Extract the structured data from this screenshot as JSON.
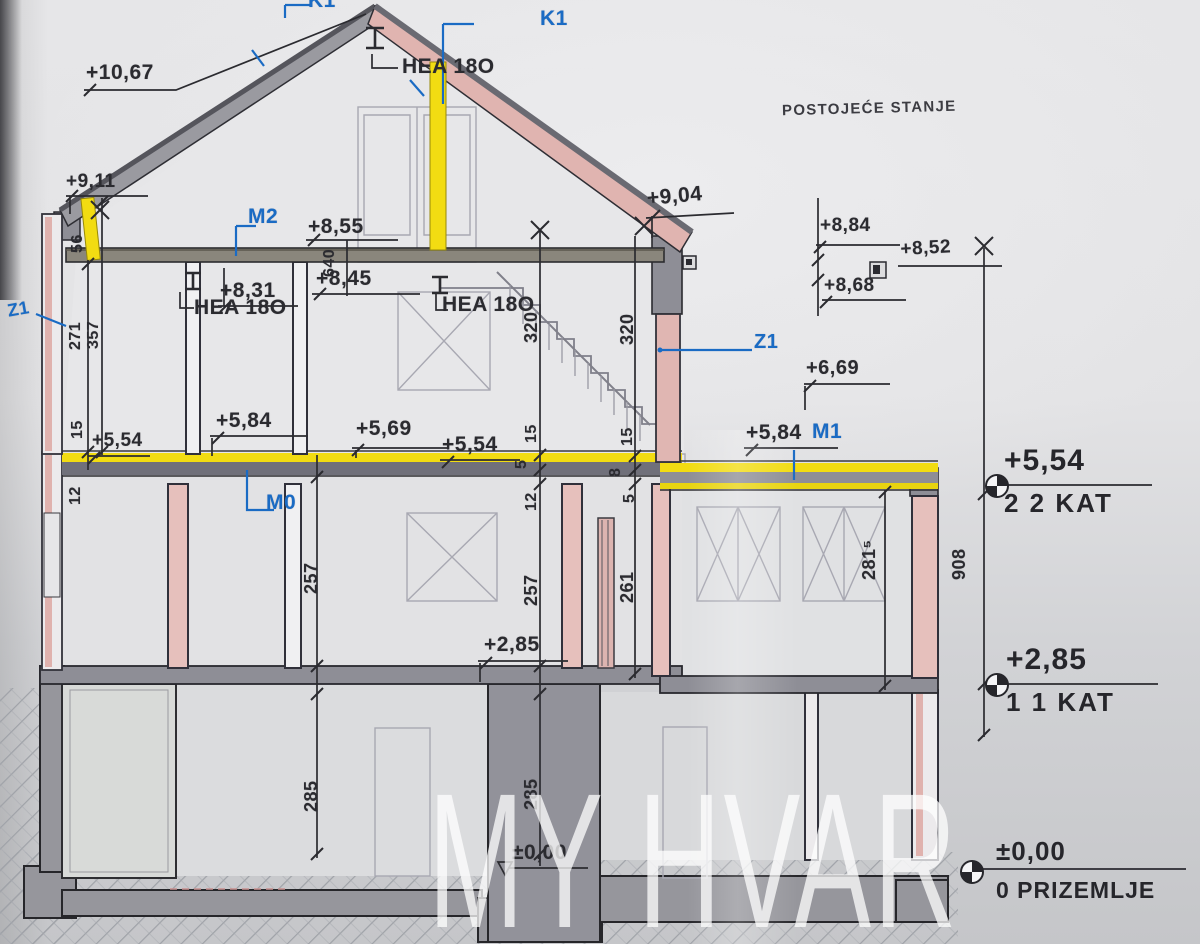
{
  "title": "POSTOJEĆE STANJE",
  "watermark": "MY HVAR",
  "drawing_type": "building cross-section, existing state",
  "colors": {
    "ink": "#2b2b30",
    "blue": "#1a6bc4",
    "highlight_yellow": "#f2dc12",
    "roof_pink": "#e0b4b0",
    "wall_pink": "#e6c0bc",
    "slab_gray": "#8e8e96",
    "ghost_gray": "#a8a8b2",
    "paper": "#e4e4e6"
  },
  "levels": [
    {
      "value": "+5,54",
      "name": "2 2 KAT"
    },
    {
      "value": "+2,85",
      "name": "1 1 KAT"
    },
    {
      "value": "±0,00",
      "name": "0 PRIZEMLJE"
    }
  ],
  "annotations": [
    {
      "id": "dim-plus-10-67",
      "text": "+10,67",
      "x": 86,
      "y": 62,
      "size": 21
    },
    {
      "id": "dim-plus-9-11",
      "text": "+9,11",
      "x": 66,
      "y": 172,
      "size": 19
    },
    {
      "id": "dim-56",
      "text": "56",
      "x": 70,
      "y": 253,
      "rot": -90,
      "size": 16
    },
    {
      "id": "label-k1-top",
      "text": "K1",
      "x": 308,
      "y": -10,
      "size": 21,
      "color": "blue",
      "bold": true
    },
    {
      "id": "label-k1-right",
      "text": "K1",
      "x": 540,
      "y": 8,
      "size": 21,
      "color": "blue",
      "bold": true
    },
    {
      "id": "label-hea-180-top",
      "text": "HEA 18O",
      "x": 402,
      "y": 56,
      "size": 21
    },
    {
      "id": "label-m2",
      "text": "M2",
      "x": 248,
      "y": 206,
      "size": 21,
      "color": "blue",
      "bold": true
    },
    {
      "id": "dim-plus-8-55",
      "text": "+8,55",
      "x": 308,
      "y": 216,
      "size": 21
    },
    {
      "id": "dim-640",
      "text": "640",
      "x": 322,
      "y": 277,
      "rot": -90,
      "size": 16
    },
    {
      "id": "dim-plus-8-45",
      "text": "+8,45",
      "x": 316,
      "y": 268,
      "size": 21
    },
    {
      "id": "dim-plus-8-31",
      "text": "+8,31",
      "x": 220,
      "y": 280,
      "size": 21
    },
    {
      "id": "label-hea-180-left",
      "text": "HEA 18O",
      "x": 194,
      "y": 297,
      "size": 21
    },
    {
      "id": "label-hea-180-mid",
      "text": "HEA 18O",
      "x": 442,
      "y": 294,
      "size": 21
    },
    {
      "id": "dim-plus-9-04",
      "text": "+9,04",
      "x": 646,
      "y": 188,
      "size": 21,
      "rot": -5
    },
    {
      "id": "dim-plus-8-84",
      "text": "+8,84",
      "x": 820,
      "y": 216,
      "size": 19
    },
    {
      "id": "dim-plus-8-52",
      "text": "+8,52",
      "x": 900,
      "y": 240,
      "size": 19,
      "rot": -3
    },
    {
      "id": "dim-plus-8-68",
      "text": "+8,68",
      "x": 824,
      "y": 276,
      "size": 19
    },
    {
      "id": "label-z1-left",
      "text": "Z1",
      "x": 6,
      "y": 302,
      "size": 18,
      "color": "blue",
      "bold": true,
      "rot": -10
    },
    {
      "id": "label-z1-right",
      "text": "Z1",
      "x": 754,
      "y": 332,
      "size": 20,
      "color": "blue",
      "bold": true
    },
    {
      "id": "dim-271",
      "text": "271",
      "x": 68,
      "y": 350,
      "rot": -90,
      "size": 16
    },
    {
      "id": "dim-357",
      "text": "357",
      "x": 86,
      "y": 349,
      "rot": -90,
      "size": 16
    },
    {
      "id": "dim-320-a",
      "text": "320",
      "x": 522,
      "y": 343,
      "rot": -90,
      "size": 18
    },
    {
      "id": "dim-320-b",
      "text": "320",
      "x": 618,
      "y": 345,
      "rot": -90,
      "size": 18
    },
    {
      "id": "dim-plus-6-69",
      "text": "+6,69",
      "x": 806,
      "y": 358,
      "size": 20
    },
    {
      "id": "dim-plus-5-84-left",
      "text": "+5,84",
      "x": 216,
      "y": 410,
      "size": 21
    },
    {
      "id": "dim-plus-5-69",
      "text": "+5,69",
      "x": 356,
      "y": 418,
      "size": 21
    },
    {
      "id": "dim-plus-5-54-center",
      "text": "+5,54",
      "x": 442,
      "y": 434,
      "size": 21
    },
    {
      "id": "dim-plus-5-54-left",
      "text": "+5,54",
      "x": 92,
      "y": 431,
      "size": 19
    },
    {
      "id": "dim-plus-5-84-right",
      "text": "+5,84",
      "x": 746,
      "y": 422,
      "size": 21
    },
    {
      "id": "label-m1",
      "text": "M1",
      "x": 812,
      "y": 421,
      "size": 21,
      "color": "blue",
      "bold": true
    },
    {
      "id": "dim-15-left",
      "text": "15",
      "x": 70,
      "y": 439,
      "rot": -90,
      "size": 16
    },
    {
      "id": "dim-15-a",
      "text": "15",
      "x": 524,
      "y": 443,
      "rot": -90,
      "size": 16
    },
    {
      "id": "dim-15-b",
      "text": "15",
      "x": 620,
      "y": 446,
      "rot": -90,
      "size": 16
    },
    {
      "id": "dim-5-a",
      "text": "5",
      "x": 514,
      "y": 469,
      "rot": -90,
      "size": 16
    },
    {
      "id": "dim-8-b",
      "text": "8",
      "x": 608,
      "y": 477,
      "rot": -90,
      "size": 16
    },
    {
      "id": "dim-12-left",
      "text": "12",
      "x": 68,
      "y": 505,
      "rot": -90,
      "size": 16
    },
    {
      "id": "dim-12-a",
      "text": "12",
      "x": 524,
      "y": 511,
      "rot": -90,
      "size": 16
    },
    {
      "id": "dim-5-b",
      "text": "5",
      "x": 622,
      "y": 503,
      "rot": -90,
      "size": 16
    },
    {
      "id": "label-m0",
      "text": "M0",
      "x": 266,
      "y": 492,
      "size": 21,
      "color": "blue",
      "bold": true
    },
    {
      "id": "dim-257-a",
      "text": "257",
      "x": 302,
      "y": 594,
      "rot": -90,
      "size": 18
    },
    {
      "id": "dim-257-b",
      "text": "257",
      "x": 522,
      "y": 606,
      "rot": -90,
      "size": 18
    },
    {
      "id": "dim-261",
      "text": "261",
      "x": 618,
      "y": 603,
      "rot": -90,
      "size": 18
    },
    {
      "id": "dim-281-5",
      "text": "281⁵",
      "x": 860,
      "y": 580,
      "rot": -90,
      "size": 18
    },
    {
      "id": "dim-908",
      "text": "908",
      "x": 950,
      "y": 580,
      "rot": -90,
      "size": 18
    },
    {
      "id": "dim-plus-2-85-center",
      "text": "+2,85",
      "x": 484,
      "y": 634,
      "size": 21
    },
    {
      "id": "dim-285-a",
      "text": "285",
      "x": 302,
      "y": 812,
      "rot": -90,
      "size": 18
    },
    {
      "id": "dim-285-b",
      "text": "285",
      "x": 522,
      "y": 810,
      "rot": -90,
      "size": 18
    },
    {
      "id": "dim-pm-0-00-center",
      "text": "±0,00",
      "x": 512,
      "y": 842,
      "size": 21
    }
  ]
}
